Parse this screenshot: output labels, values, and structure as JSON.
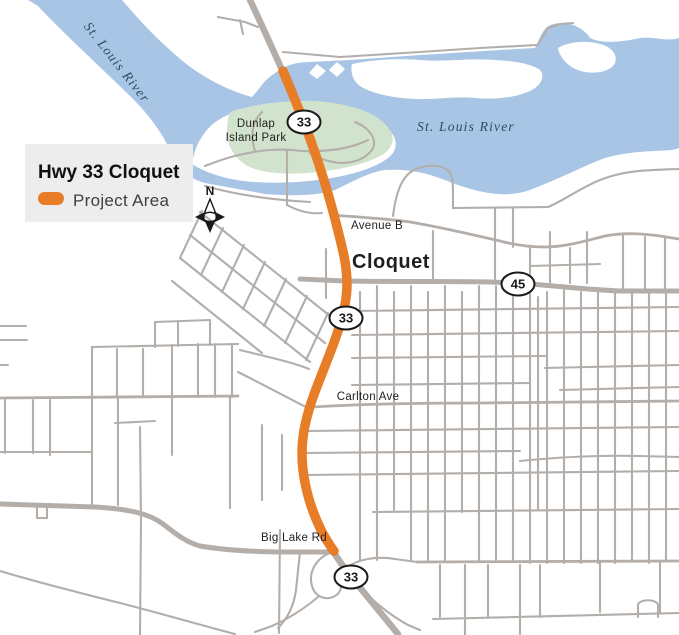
{
  "legend": {
    "title": "Hwy 33 Cloquet",
    "item_label": "Project Area"
  },
  "labels": {
    "river_upper": "St. Louis River",
    "river_lower": "St. Louis River",
    "park_line1": "Dunlap",
    "park_line2": "Island Park",
    "avenue_b": "Avenue B",
    "city": "Cloquet",
    "carlton_ave": "Carlton Ave",
    "big_lake_rd": "Big Lake Rd"
  },
  "shields": {
    "hwy33": "33",
    "hwy45": "45"
  },
  "compass": {
    "north": "N"
  },
  "colors": {
    "water": "#a8c5e6",
    "park": "#d2e3cd",
    "road": "#b3aeaa",
    "project": "#e87d28",
    "legend_bg": "#ededed",
    "river_label": "#2a4a66",
    "label": "#1f1f1f"
  }
}
